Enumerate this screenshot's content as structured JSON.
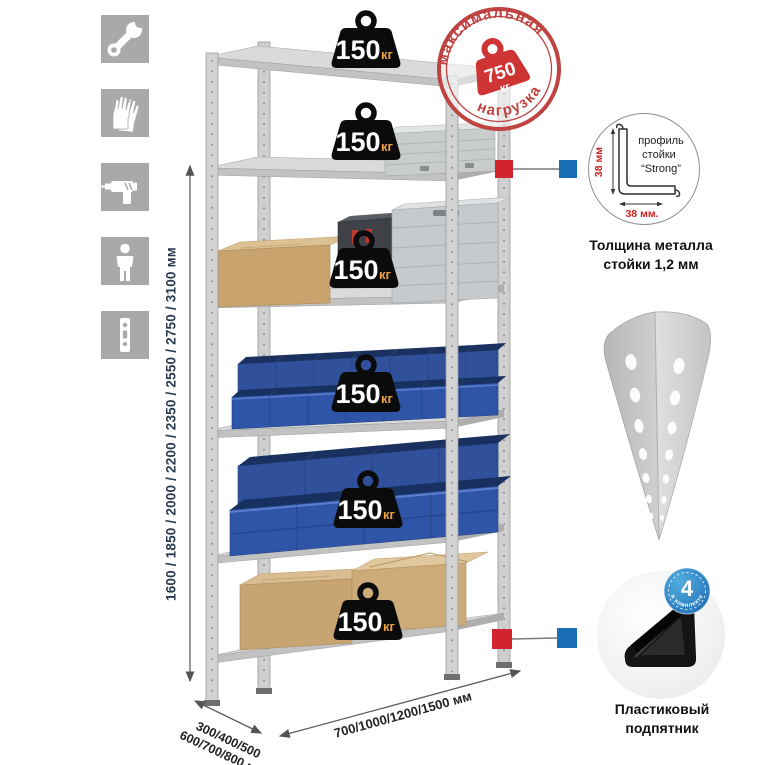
{
  "left_icons": [
    {
      "name": "wrench-icon"
    },
    {
      "name": "gloves-icon"
    },
    {
      "name": "drill-icon"
    },
    {
      "name": "person-icon"
    },
    {
      "name": "rack-post-icon"
    }
  ],
  "dimensions": {
    "height": "1600 / 1850 / 2000 / 2200 / 2350 / 2550 / 2750 / 3100 мм",
    "depth_line1": "300/400/500",
    "depth_line2": "600/700/800 мм",
    "width": "700/1000/1200/1500 мм"
  },
  "max_load_stamp": {
    "arc_top": "максимальная",
    "arc_bottom": "нагрузка",
    "value": "750",
    "unit": "кг"
  },
  "shelf_load_badges": [
    {
      "value": "150",
      "unit": "кг"
    },
    {
      "value": "150",
      "unit": "кг"
    },
    {
      "value": "150",
      "unit": "кг"
    },
    {
      "value": "150",
      "unit": "кг"
    },
    {
      "value": "150",
      "unit": "кг"
    },
    {
      "value": "150",
      "unit": "кг"
    }
  ],
  "profile_callout": {
    "label_line1": "профиль",
    "label_line2": "стойки",
    "label_line3": "“Strong”",
    "dim_vertical": "38 мм",
    "dim_horizontal": "38 мм.",
    "caption_line1": "Толщина металла",
    "caption_line2": "стойки 1,2 мм"
  },
  "foot_callout": {
    "badge_value": "4",
    "badge_ring_text": "в комплекте",
    "caption_line1": "Пластиковый",
    "caption_line2": "подпятник"
  },
  "colors": {
    "accent_red": "#d2232e",
    "accent_blue": "#1b6fb5",
    "stamp_red": "#bf4340",
    "bin_blue": "#2f55a9"
  }
}
